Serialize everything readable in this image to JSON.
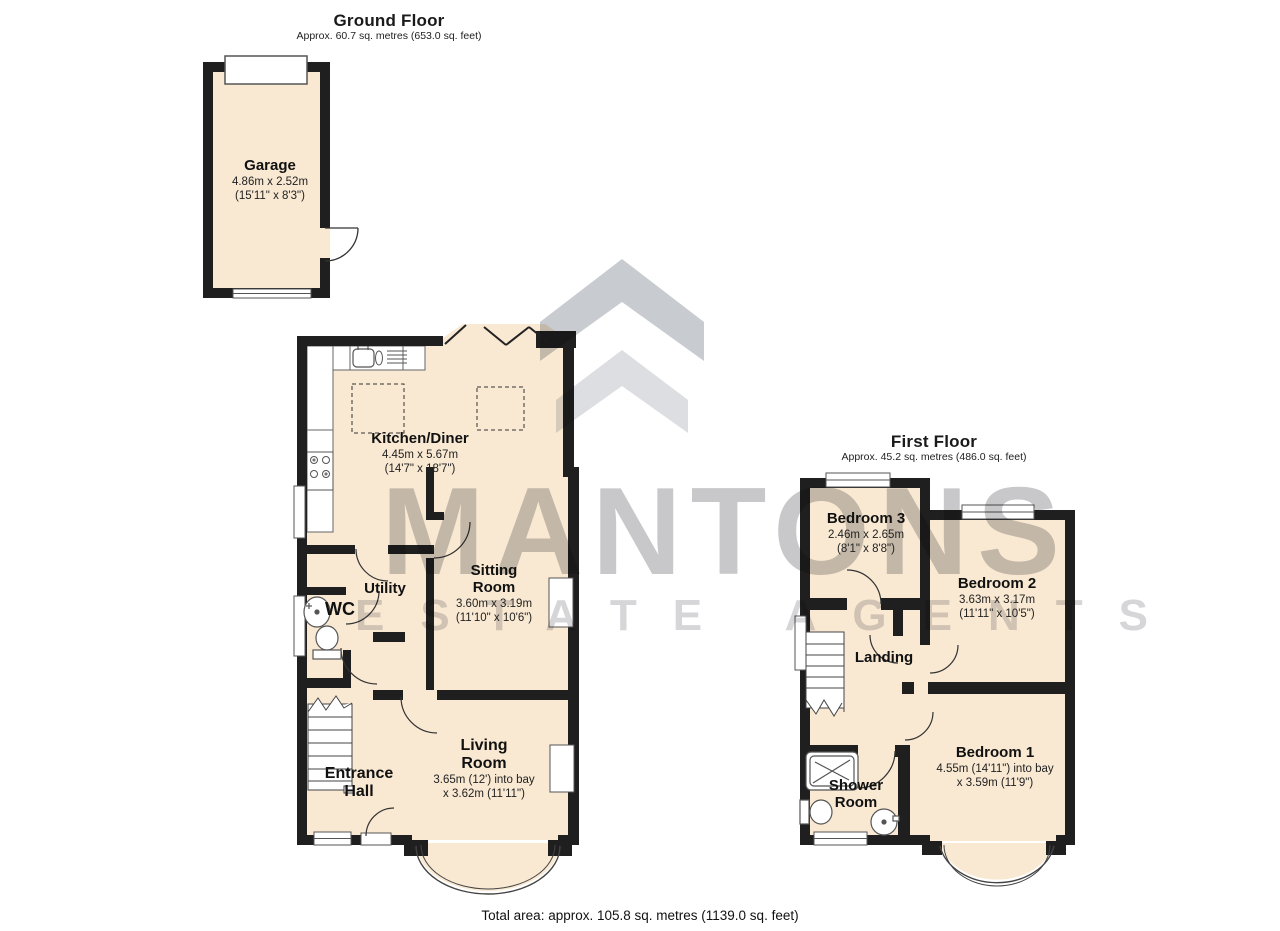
{
  "footer": {
    "total_area": "Total area: approx. 105.8 sq. metres (1139.0 sq. feet)"
  },
  "watermark": {
    "brand": "MANTONS",
    "tagline": "ESTATE AGENTS",
    "logo_icon": "roof-chevrons-icon"
  },
  "colors": {
    "room_fill": "#F9E9D3",
    "wall": "#1F1F1F",
    "watermark_gray": "#C9C9C9"
  },
  "floors": {
    "ground": {
      "title": "Ground Floor",
      "subtitle": "Approx. 60.7 sq. metres (653.0 sq. feet)",
      "rooms": {
        "garage": {
          "name": "Garage",
          "metric": "4.86m x 2.52m",
          "imperial": "(15'11\" x 8'3\")"
        },
        "kitchen": {
          "name": "Kitchen/Diner",
          "metric": "4.45m x 5.67m",
          "imperial": "(14'7\" x 18'7\")"
        },
        "sitting": {
          "name": "Sitting Room",
          "metric": "3.60m x 3.19m",
          "imperial": "(11'10\" x 10'6\")"
        },
        "utility": {
          "name": "Utility"
        },
        "wc": {
          "name": "WC"
        },
        "entrance": {
          "name": "Entrance Hall"
        },
        "living": {
          "name": "Living Room",
          "metric": "3.65m (12') into bay",
          "imperial": "x 3.62m (11'11\")"
        }
      }
    },
    "first": {
      "title": "First Floor",
      "subtitle": "Approx. 45.2 sq. metres (486.0 sq. feet)",
      "rooms": {
        "bed3": {
          "name": "Bedroom 3",
          "metric": "2.46m x 2.65m",
          "imperial": "(8'1\" x 8'8\")"
        },
        "bed2": {
          "name": "Bedroom 2",
          "metric": "3.63m x 3.17m",
          "imperial": "(11'11\" x 10'5\")"
        },
        "landing": {
          "name": "Landing"
        },
        "shower": {
          "name": "Shower Room"
        },
        "bed1": {
          "name": "Bedroom 1",
          "metric": "4.55m (14'11\") into bay",
          "imperial": "x 3.59m (11'9\")"
        }
      }
    }
  }
}
